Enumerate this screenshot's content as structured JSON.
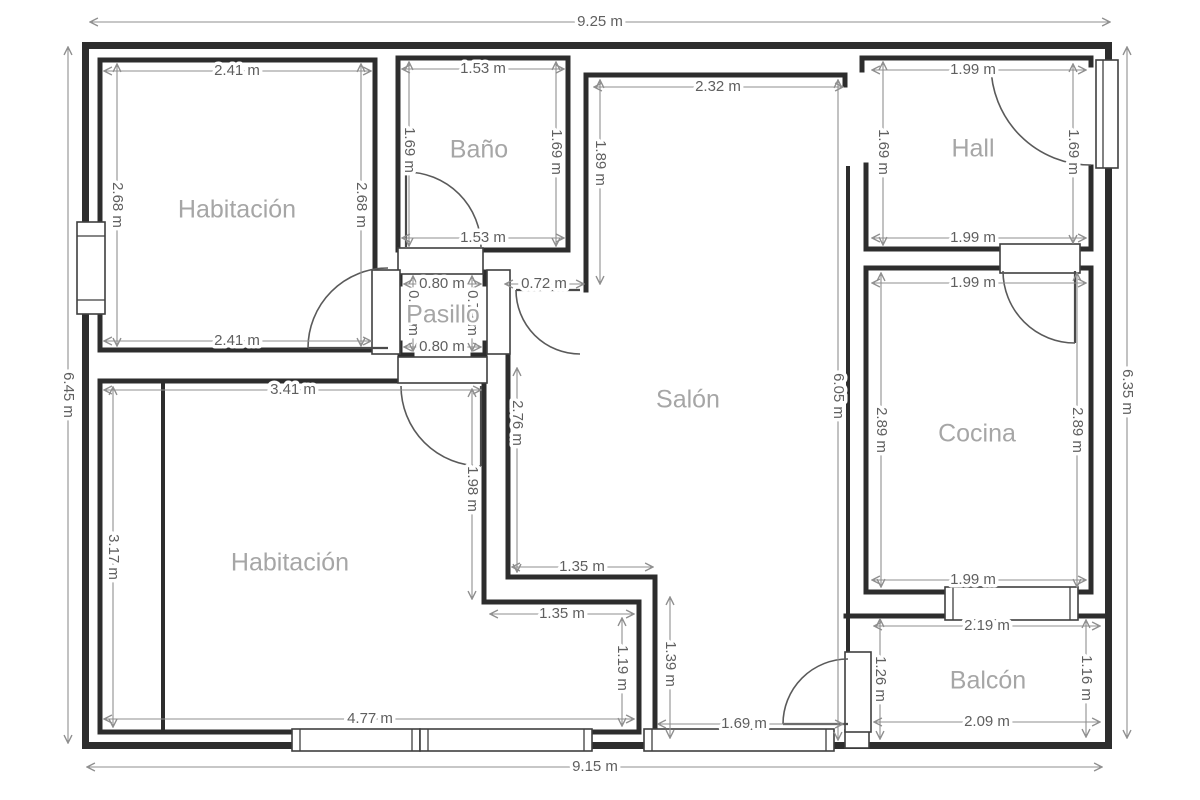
{
  "plan_title": "Floor plan",
  "unit": "m",
  "colors": {
    "wall": "#2d2d2d",
    "dimension_line": "#8f8f8f",
    "dimension_text": "#5f5f5f",
    "room_text": "#a6a6a6",
    "background": "#ffffff"
  },
  "overall_dims": {
    "top": "9.25 m",
    "bottom": "9.15 m",
    "left": "6.45 m",
    "right": "6.35 m"
  },
  "rooms": {
    "habitacion_tl": {
      "name": "Habitación",
      "dim_top": "2.41 m",
      "dim_bottom": "2.41 m",
      "dim_left": "2.68 m",
      "dim_right": "2.68 m"
    },
    "bano": {
      "name": "Baño",
      "dim_top": "1.53 m",
      "dim_bottom": "1.53 m",
      "dim_left": "1.69 m",
      "dim_right": "1.69 m"
    },
    "pasillo": {
      "name": "Pasillo",
      "dim_top": "0.80 m",
      "dim_bottom": "0.80 m",
      "dim_left": "0.79 m",
      "dim_right": "0.79 m"
    },
    "salon": {
      "name": "Salón",
      "dim_top": "2.32 m",
      "dim_upper_left": "1.89 m",
      "dim_doorway": "0.72 m",
      "dim_left": "2.76 m",
      "dim_right": "6.05 m",
      "dim_step": "1.35 m",
      "dim_lower_right": "1.39 m",
      "dim_window": "1.69 m"
    },
    "hall": {
      "name": "Hall",
      "dim_top": "1.99 m",
      "dim_bottom": "1.99 m",
      "dim_left": "1.69 m",
      "dim_right": "1.69 m"
    },
    "cocina": {
      "name": "Cocina",
      "dim_top": "1.99 m",
      "dim_bottom": "1.99 m",
      "dim_left": "2.89 m",
      "dim_right": "2.89 m"
    },
    "habitacion_bl": {
      "name": "Habitación",
      "dim_top": "3.41 m",
      "dim_left": "3.17 m",
      "dim_bottom": "4.77 m",
      "dim_right": "1.98 m",
      "dim_alcove_width": "1.35 m",
      "dim_alcove_height": "1.19 m"
    },
    "balcon": {
      "name": "Balcón",
      "dim_top": "2.19 m",
      "dim_bottom": "2.09 m",
      "dim_left": "1.26 m",
      "dim_right": "1.16 m"
    }
  }
}
